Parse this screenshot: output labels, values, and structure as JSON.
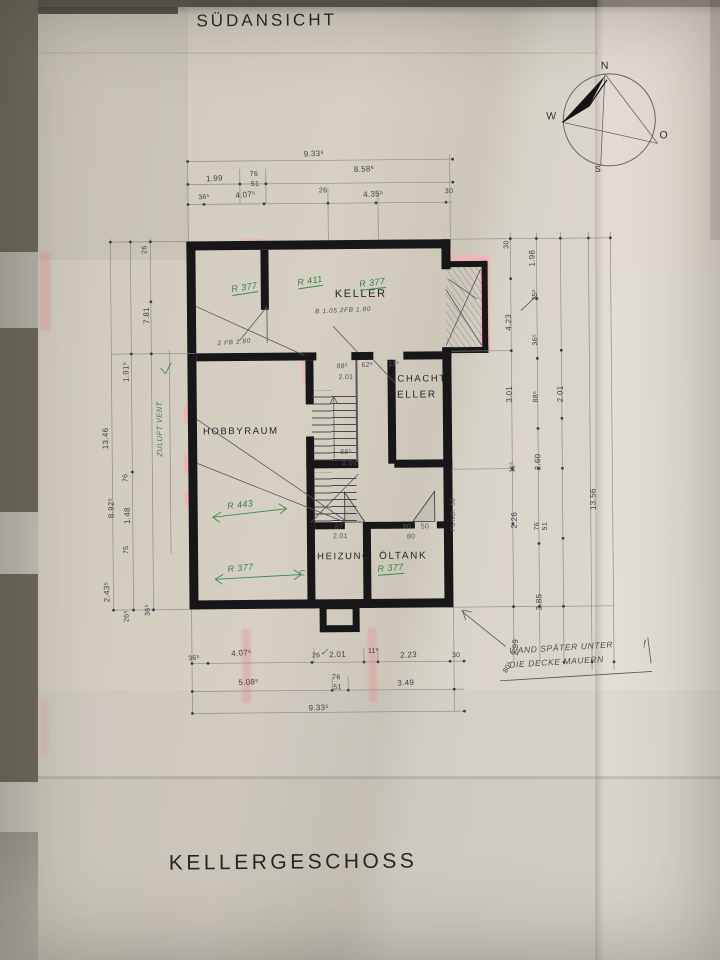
{
  "titles": {
    "top": "SÜDANSICHT",
    "bottom": "KELLERGESCHOSS"
  },
  "compass": {
    "n": "N",
    "w": "W",
    "e": "O",
    "s": "S"
  },
  "rooms": [
    {
      "t": "KELLER",
      "x": 336,
      "y": 288,
      "f": 11,
      "n": "room-label-keller"
    },
    {
      "t": "SCHACHT",
      "x": 390,
      "y": 374,
      "f": 9.5,
      "n": "room-label-schacht"
    },
    {
      "t": "KELLER",
      "x": 389,
      "y": 390,
      "f": 10,
      "n": "room-label-schacht-keller"
    },
    {
      "t": "HOBBYRAUM",
      "x": 203,
      "y": 425,
      "f": 9.5,
      "n": "room-label-hobbyraum"
    },
    {
      "t": "HEIZUNG",
      "x": 316,
      "y": 551,
      "f": 9.5,
      "n": "room-label-heizung"
    },
    {
      "t": "ÖLTANK",
      "x": 378,
      "y": 551,
      "f": 10,
      "n": "room-label-oeltank"
    }
  ],
  "dims_top": [
    {
      "t": "9.33⁵",
      "x": 306,
      "y": 149,
      "r": -1
    },
    {
      "t": "1.99",
      "x": 208,
      "y": 173,
      "r": -2
    },
    {
      "t": "76",
      "x": 252,
      "y": 170,
      "f": 7
    },
    {
      "t": "51",
      "x": 253,
      "y": 180,
      "f": 7
    },
    {
      "t": "8.58⁵",
      "x": 356,
      "y": 165,
      "r": -2
    },
    {
      "t": "36⁵",
      "x": 200,
      "y": 193,
      "f": 7,
      "r": -4
    },
    {
      "t": "4.07⁵",
      "x": 237,
      "y": 190,
      "r": -4
    },
    {
      "t": "26",
      "x": 321,
      "y": 187,
      "f": 7
    },
    {
      "t": "4.35⁵",
      "x": 365,
      "y": 190,
      "r": -2
    },
    {
      "t": "30",
      "x": 447,
      "y": 189,
      "f": 7
    }
  ],
  "dims_bottom": [
    {
      "t": "36⁵",
      "x": 186,
      "y": 654,
      "f": 7,
      "r": -4
    },
    {
      "t": "4.07⁵",
      "x": 229,
      "y": 648,
      "r": -3
    },
    {
      "t": "26",
      "x": 310,
      "y": 652,
      "f": 7
    },
    {
      "t": "2.01",
      "x": 327,
      "y": 650,
      "r": -2
    },
    {
      "t": "11⁵",
      "x": 366,
      "y": 648,
      "f": 7
    },
    {
      "t": "2.23",
      "x": 398,
      "y": 651,
      "r": -2
    },
    {
      "t": "30",
      "x": 450,
      "y": 653,
      "f": 7
    },
    {
      "t": "5.08⁵",
      "x": 236,
      "y": 677,
      "r": -2
    },
    {
      "t": "76",
      "x": 330,
      "y": 674,
      "f": 7
    },
    {
      "t": "51",
      "x": 331,
      "y": 684,
      "f": 7
    },
    {
      "t": "3.49",
      "x": 395,
      "y": 679,
      "r": -2
    },
    {
      "t": "9.33⁵",
      "x": 306,
      "y": 703,
      "r": -1
    }
  ],
  "dims_left": [
    {
      "t": "13.46",
      "x": 101,
      "y": 447,
      "r": -90
    },
    {
      "t": "1.91⁵",
      "x": 122,
      "y": 380,
      "r": -90
    },
    {
      "t": "7.81",
      "x": 143,
      "y": 322,
      "r": -90
    },
    {
      "t": "26",
      "x": 143,
      "y": 252,
      "f": 7,
      "r": -90
    },
    {
      "t": "76",
      "x": 122,
      "y": 480,
      "f": 7,
      "r": -90
    },
    {
      "t": "1.48",
      "x": 122,
      "y": 522,
      "r": -90
    },
    {
      "t": "8.92⁵",
      "x": 106,
      "y": 516,
      "r": -90
    },
    {
      "t": "75",
      "x": 122,
      "y": 552,
      "f": 7,
      "r": -90
    },
    {
      "t": "2.43⁵",
      "x": 101,
      "y": 600,
      "r": -90
    },
    {
      "t": "26⁵",
      "x": 122,
      "y": 620,
      "f": 7,
      "r": -90
    },
    {
      "t": "36⁵",
      "x": 143,
      "y": 614,
      "f": 7,
      "r": -90
    }
  ],
  "dims_right": [
    {
      "t": "30",
      "x": 505,
      "y": 250,
      "f": 7,
      "r": -90
    },
    {
      "t": "1.98",
      "x": 529,
      "y": 268,
      "r": -90
    },
    {
      "t": "25⁵",
      "x": 533,
      "y": 302,
      "f": 7,
      "r": -90
    },
    {
      "t": "4.23",
      "x": 505,
      "y": 332,
      "r": -90
    },
    {
      "t": "36⁵",
      "x": 533,
      "y": 347,
      "f": 7,
      "r": -90
    },
    {
      "t": "3.01",
      "x": 505,
      "y": 404,
      "r": -90
    },
    {
      "t": "88⁵",
      "x": 533,
      "y": 404,
      "f": 7,
      "r": -90
    },
    {
      "t": "2.01",
      "x": 556,
      "y": 404,
      "r": -90
    },
    {
      "t": "2.60",
      "x": 533,
      "y": 472,
      "r": -90
    },
    {
      "t": "11⁵",
      "x": 509,
      "y": 474,
      "f": 7,
      "r": -90
    },
    {
      "t": "2.26",
      "x": 509,
      "y": 530,
      "r": -90
    },
    {
      "t": "76",
      "x": 533,
      "y": 532,
      "f": 7,
      "r": -90
    },
    {
      "t": "51",
      "x": 541,
      "y": 532,
      "f": 7,
      "r": -90
    },
    {
      "t": "3.85",
      "x": 533,
      "y": 612,
      "r": -90
    },
    {
      "t": "2.99",
      "x": 509,
      "y": 657,
      "r": -90
    },
    {
      "t": "80⁵",
      "x": 500,
      "y": 672,
      "f": 7,
      "r": -60
    },
    {
      "t": "13.56",
      "x": 588,
      "y": 512,
      "r": -90
    }
  ],
  "dims_interior": [
    {
      "t": "88⁵",
      "x": 337,
      "y": 363,
      "f": 7
    },
    {
      "t": "62⁵",
      "x": 362,
      "y": 362,
      "f": 7
    },
    {
      "t": "11⁵",
      "x": 389,
      "y": 361,
      "f": 7
    },
    {
      "t": "2.01",
      "x": 339,
      "y": 374,
      "f": 7
    },
    {
      "t": "88⁵",
      "x": 340,
      "y": 449,
      "f": 7
    },
    {
      "t": "2.01",
      "x": 342,
      "y": 460,
      "f": 7
    },
    {
      "t": "87",
      "x": 334,
      "y": 524,
      "f": 7
    },
    {
      "t": "2.01",
      "x": 332,
      "y": 533,
      "f": 7
    },
    {
      "t": "80",
      "x": 402,
      "y": 524,
      "f": 7
    },
    {
      "t": "50",
      "x": 420,
      "y": 524,
      "f": 7
    },
    {
      "t": "80",
      "x": 406,
      "y": 534,
      "f": 7
    }
  ],
  "green_notes": [
    {
      "t": "R 377",
      "x": 232,
      "y": 283,
      "r": -8,
      "u": 1
    },
    {
      "t": "R 411",
      "x": 298,
      "y": 277,
      "r": -8,
      "u": 1
    },
    {
      "t": "R 377",
      "x": 360,
      "y": 279,
      "r": -6,
      "u": 1
    },
    {
      "t": "R 443",
      "x": 226,
      "y": 500,
      "r": -6
    },
    {
      "t": "R 377",
      "x": 226,
      "y": 563,
      "r": -5
    },
    {
      "t": "C",
      "x": 298,
      "y": 568,
      "f": 8
    },
    {
      "t": "R 377",
      "x": 376,
      "y": 564,
      "r": -4,
      "u": 1
    },
    {
      "t": "ZULUFT VENT.",
      "x": 155,
      "y": 455,
      "r": -90,
      "f": 7.5
    },
    {
      "t": "✓",
      "x": 318,
      "y": 647,
      "f": 10
    }
  ],
  "pencil_notes": [
    {
      "t": "B 1.05 2FB 1.80",
      "x": 316,
      "y": 308,
      "f": 6.5,
      "r": -2,
      "n": "door-spec-keller"
    },
    {
      "t": "2 FB 1.80",
      "x": 218,
      "y": 339,
      "f": 6.5,
      "r": -4,
      "n": "door-spec-left-room"
    },
    {
      "t": "FUND. 50",
      "x": 449,
      "y": 532,
      "f": 6.5,
      "r": -90,
      "n": "foundation-note"
    },
    {
      "t": "WAND SPÄTER UNTER",
      "x": 507,
      "y": 647,
      "f": 8.5,
      "r": -3,
      "n": "wall-note-line1"
    },
    {
      "t": "DIE DECKE MAUERN",
      "x": 507,
      "y": 661,
      "f": 8.5,
      "r": -3,
      "n": "wall-note-line2"
    },
    {
      "t": "!",
      "x": 641,
      "y": 641,
      "f": 11,
      "n": "wall-note-exclamation"
    }
  ],
  "colors": {
    "wall_ink": "#17171a",
    "pencil": "#52525c",
    "green_ink": "#35814a",
    "red_marker": "#e98a90",
    "paper": "#d3cdc0"
  }
}
